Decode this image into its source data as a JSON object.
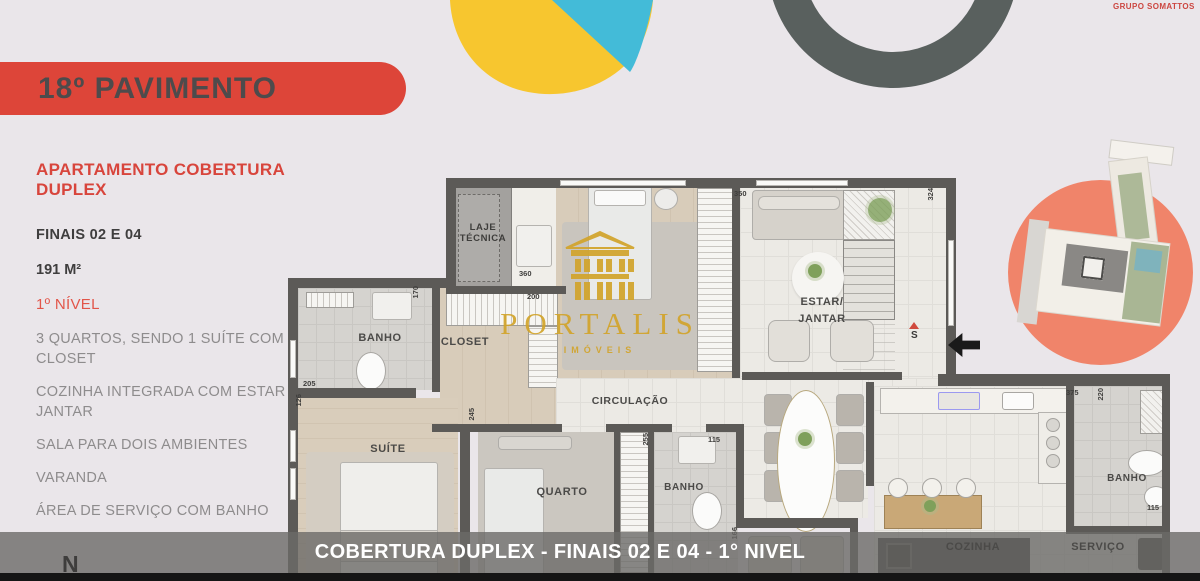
{
  "page": {
    "background": "#EAE6EA"
  },
  "brand": {
    "label": "GRUPO SOMATTOS",
    "color": "#CC4640"
  },
  "banner": {
    "title": "18º PAVIMENTO",
    "color": "#DD4539"
  },
  "sidebar": {
    "title": "APARTAMENTO COBERTURA DUPLEX",
    "units": "FINAIS 02 E 04",
    "area": "191 M²",
    "level": "1º NÍVEL",
    "features": [
      "3 QUARTOS, SENDO 1 SUÍTE COM CLOSET",
      "COZINHA INTEGRADA COM ESTAR E JANTAR",
      "SALA PARA DOIS AMBIENTES",
      "VARANDA",
      "ÁREA DE SERVIÇO COM BANHO"
    ]
  },
  "watermark": {
    "name": "PORTALIS",
    "tagline": "IMÓVEIS",
    "color": "#D2A42B"
  },
  "floorplan": {
    "rooms": [
      {
        "id": "laje-tecnica",
        "label": "LAJE\nTÉCNICA"
      },
      {
        "id": "banho-suite",
        "label": "BANHO"
      },
      {
        "id": "closet",
        "label": "CLOSET"
      },
      {
        "id": "suite",
        "label": "SUÍTE"
      },
      {
        "id": "quarto",
        "label": "QUARTO"
      },
      {
        "id": "circulacao",
        "label": "CIRCULAÇÃO"
      },
      {
        "id": "banho-meio",
        "label": "BANHO"
      },
      {
        "id": "estar-jantar",
        "label": "ESTAR/\nJANTAR"
      },
      {
        "id": "cozinha",
        "label": "COZINHA"
      },
      {
        "id": "servico",
        "label": "SERVIÇO"
      },
      {
        "id": "banho-servico",
        "label": "BANHO"
      }
    ],
    "dims": [
      "350",
      "324",
      "360",
      "200",
      "170",
      "205",
      "126",
      "245",
      "255",
      "115",
      "375",
      "220",
      "115",
      "166"
    ],
    "stair_marker": "S",
    "north_indicator": "N",
    "caption": "COBERTURA DUPLEX - FINAIS 02 E 04 - 1° NIVEL"
  },
  "colors": {
    "accent_red": "#DD4539",
    "yellow": "#F7C62F",
    "cyan": "#43BBD8",
    "ring_gray": "#59605E",
    "salmon": "#F0846A",
    "wall": "#5C5A57",
    "gold": "#D2A42B"
  }
}
